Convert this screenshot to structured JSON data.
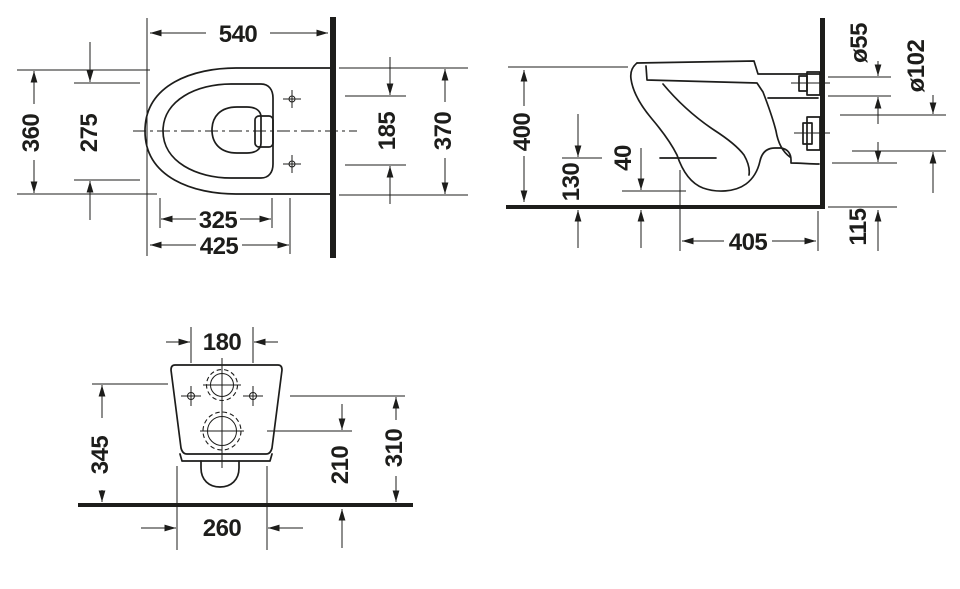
{
  "drawing": {
    "background": "#ffffff",
    "line_color": "#1d1d1b",
    "views": {
      "plan": {
        "dims": {
          "top": "540",
          "left_outer": "360",
          "left_inner": "275",
          "right_inner": "185",
          "right_outer": "370",
          "bottom_inner": "325",
          "bottom_outer": "425"
        }
      },
      "side": {
        "dims": {
          "left": "400",
          "inner_left": "130",
          "inner_right": "40",
          "pipe_top_dia": "ø55",
          "pipe_bottom_dia": "ø102",
          "bottom": "405",
          "right_bottom": "115"
        }
      },
      "rear": {
        "dims": {
          "top": "180",
          "left": "345",
          "inner": "210",
          "right": "310",
          "bottom": "260"
        }
      }
    }
  }
}
